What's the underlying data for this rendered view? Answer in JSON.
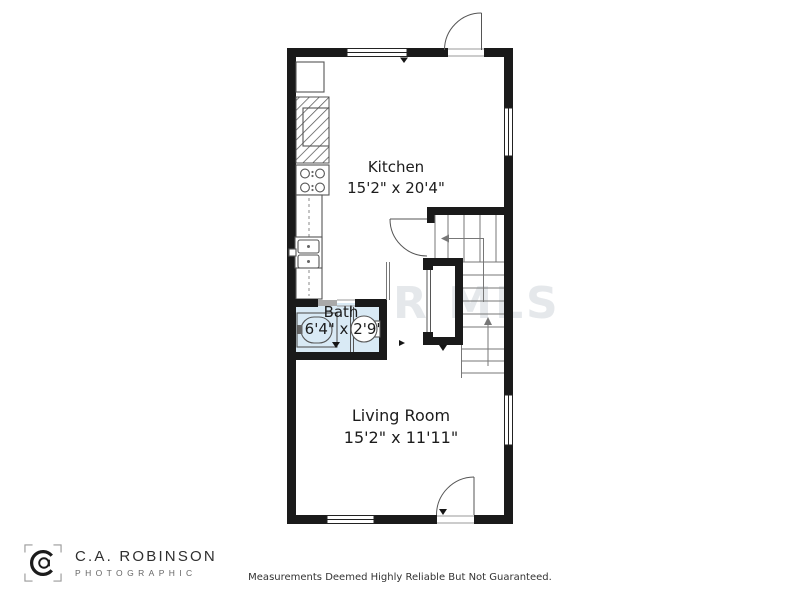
{
  "plan": {
    "rooms": [
      {
        "name": "Kitchen",
        "dims": "15'2\" x 20'4\""
      },
      {
        "name": "Bath",
        "dims": "6'4\" x 2'9\""
      },
      {
        "name": "Living Room",
        "dims": "15'2\" x 11'11\""
      }
    ],
    "watermark": "R MLS"
  },
  "branding": {
    "company": "C.A. ROBINSON",
    "tagline": "PHOTOGRAPHIC"
  },
  "footer": {
    "disclaimer": "Measurements Deemed Highly Reliable But Not Guaranteed."
  },
  "colors": {
    "wall": "#1a1a1a",
    "bath_fill": "#d9eaf5",
    "line": "#555555",
    "watermark": "#ccd2d8"
  }
}
